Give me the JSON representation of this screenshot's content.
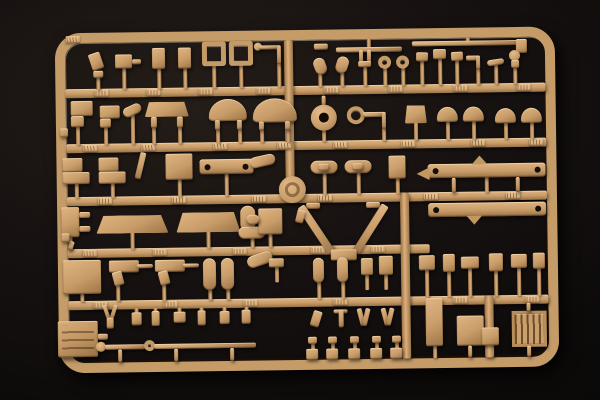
{
  "scene": {
    "description": "Photograph of a tan sand-colored injection-molded plastic model kit sprue (parts tree) holding dozens of small vehicle parts, lit from the upper left against a black studio background",
    "subject": "model-kit-sprue",
    "background": "black studio backdrop",
    "legible_text": "none (embossed part-number tabs are illegible at this resolution)"
  },
  "palette": {
    "plastic_light": "#e0b583",
    "plastic_mid": "#c89c68",
    "plastic_dark": "#9a7246",
    "plastic_shadow": "#5f422a",
    "hole_dark": "#140d07",
    "background_center": "#241d18",
    "background_edge": "#080706"
  },
  "frame": {
    "x": 57,
    "y": 30,
    "w": 500,
    "h": 340,
    "border": 10,
    "radius": 26
  },
  "runners": [
    [
      "main-runner-h1",
      67,
      86,
      480,
      9
    ],
    [
      "main-runner-h2",
      67,
      141,
      480,
      9
    ],
    [
      "main-runner-h3",
      67,
      194,
      480,
      9
    ],
    [
      "main-runner-h4",
      67,
      246,
      362,
      9
    ],
    [
      "main-runner-h5",
      67,
      298,
      480,
      9
    ],
    [
      "main-runner-v-top",
      286,
      40,
      9,
      156
    ],
    [
      "main-runner-v-bottom",
      400,
      194,
      9,
      166
    ],
    [
      "main-runner-v-right",
      483,
      298,
      9,
      62
    ]
  ],
  "tabs": {
    "w": 14,
    "h": 7,
    "positions": [
      [
        68,
        33
      ],
      [
        96,
        87
      ],
      [
        148,
        87
      ],
      [
        200,
        87
      ],
      [
        258,
        87
      ],
      [
        326,
        87
      ],
      [
        390,
        87
      ],
      [
        455,
        87
      ],
      [
        518,
        87
      ],
      [
        84,
        142
      ],
      [
        142,
        142
      ],
      [
        214,
        142
      ],
      [
        278,
        142
      ],
      [
        334,
        142
      ],
      [
        402,
        142
      ],
      [
        472,
        142
      ],
      [
        530,
        142
      ],
      [
        98,
        195
      ],
      [
        172,
        195
      ],
      [
        252,
        195
      ],
      [
        318,
        195
      ],
      [
        424,
        195
      ],
      [
        506,
        195
      ],
      [
        82,
        247
      ],
      [
        152,
        247
      ],
      [
        232,
        247
      ],
      [
        310,
        247
      ],
      [
        370,
        247
      ],
      [
        92,
        299
      ],
      [
        162,
        299
      ],
      [
        242,
        299
      ],
      [
        332,
        299
      ],
      [
        452,
        299
      ],
      [
        524,
        299
      ]
    ]
  },
  "part_format": "[name, shape, x, y, w, h, rotation_deg, stem_px(+down/-up)]",
  "parts": [
    [
      "seat-part",
      "r",
      92,
      50,
      12,
      17,
      -18,
      0
    ],
    [
      "seat-foot",
      "r",
      95,
      68,
      10,
      7,
      0,
      12
    ],
    [
      "gearbox-part",
      "r",
      117,
      52,
      17,
      14,
      0,
      21
    ],
    [
      "gearbox-arm",
      "r",
      134,
      57,
      9,
      5,
      0,
      0
    ],
    [
      "tall-part-a",
      "r",
      154,
      46,
      13,
      21,
      0,
      20
    ],
    [
      "tall-part-b",
      "r",
      180,
      46,
      13,
      21,
      0,
      20
    ],
    [
      "seat-frame-a",
      "fr",
      204,
      40,
      24,
      25,
      0,
      22
    ],
    [
      "seat-frame-b",
      "fr",
      231,
      40,
      24,
      25,
      0,
      22
    ],
    [
      "rod-arm-tip",
      "c",
      256,
      42,
      8,
      8,
      0,
      0
    ],
    [
      "rod-arm-h",
      "r",
      261,
      45,
      20,
      4,
      0,
      0
    ],
    [
      "rod-arm-v",
      "r",
      279,
      45,
      4,
      19,
      0,
      23
    ],
    [
      "bar-small",
      "r",
      316,
      44,
      14,
      6,
      0,
      0
    ],
    [
      "spring-bar",
      "r",
      338,
      48,
      66,
      5,
      0,
      -8
    ],
    [
      "long-rod",
      "r",
      414,
      43,
      112,
      5,
      0,
      -3
    ],
    [
      "clevis-part",
      "r",
      518,
      42,
      11,
      14,
      0,
      0
    ],
    [
      "leaf-part-a",
      "cap",
      316,
      58,
      12,
      17,
      -20,
      12
    ],
    [
      "leaf-part-b",
      "cap",
      338,
      57,
      12,
      17,
      18,
      13
    ],
    [
      "u-bracket-l",
      "r",
      361,
      51,
      4,
      13,
      0,
      0
    ],
    [
      "u-bracket-r",
      "r",
      369,
      51,
      4,
      13,
      0,
      0
    ],
    [
      "u-bracket-base",
      "r",
      360,
      62,
      13,
      6,
      0,
      19
    ],
    [
      "ring-part-a",
      "ring",
      380,
      57,
      13,
      13,
      0,
      17
    ],
    [
      "ring-part-b",
      "ring",
      398,
      57,
      13,
      13,
      0,
      17
    ],
    [
      "post-head-a",
      "r",
      418,
      54,
      12,
      9,
      2,
      24
    ],
    [
      "post-head-b",
      "r",
      435,
      51,
      13,
      10,
      0,
      26
    ],
    [
      "post-head-c",
      "r",
      453,
      54,
      12,
      9,
      -2,
      24
    ],
    [
      "elbow-part-h",
      "r",
      468,
      58,
      14,
      5,
      0,
      0
    ],
    [
      "elbow-part-v",
      "r",
      478,
      58,
      4,
      14,
      0,
      15
    ],
    [
      "flat-part",
      "cap",
      489,
      62,
      17,
      6,
      -8,
      19
    ],
    [
      "knob-part",
      "c",
      511,
      53,
      11,
      11,
      0,
      0
    ],
    [
      "knob-body",
      "r",
      513,
      63,
      8,
      8,
      0,
      16
    ],
    [
      "step-bracket-a",
      "r",
      72,
      98,
      22,
      15,
      0,
      0
    ],
    [
      "step-bracket-a2",
      "r",
      72,
      113,
      13,
      11,
      0,
      18
    ],
    [
      "step-bracket-b",
      "r",
      101,
      103,
      20,
      13,
      0,
      0
    ],
    [
      "step-bracket-b2",
      "r",
      101,
      116,
      11,
      9,
      0,
      17
    ],
    [
      "wing-part-a",
      "cap",
      124,
      103,
      19,
      10,
      -24,
      29
    ],
    [
      "shelf-part",
      "tz",
      146,
      100,
      44,
      15,
      0,
      0
    ],
    [
      "shelf-foot-a",
      "r",
      152,
      115,
      6,
      11,
      0,
      16
    ],
    [
      "shelf-foot-b",
      "r",
      178,
      115,
      6,
      11,
      0,
      16
    ],
    [
      "fender-a",
      "dm",
      210,
      98,
      38,
      22,
      0,
      0
    ],
    [
      "fender-a-foot1",
      "r",
      216,
      119,
      5,
      10,
      0,
      13
    ],
    [
      "fender-a-foot2",
      "r",
      238,
      119,
      5,
      10,
      0,
      13
    ],
    [
      "fender-b",
      "dm",
      254,
      98,
      44,
      24,
      0,
      0
    ],
    [
      "fender-b-foot1",
      "r",
      260,
      121,
      5,
      9,
      0,
      12
    ],
    [
      "fender-b-foot2",
      "r",
      286,
      121,
      5,
      9,
      0,
      12
    ],
    [
      "hub-stem-up",
      "r",
      323,
      96,
      4,
      10,
      0,
      0
    ],
    [
      "hub-part",
      "ch",
      312,
      105,
      26,
      26,
      0,
      11
    ],
    [
      "ring-arm-ring",
      "ring",
      348,
      107,
      18,
      18,
      0,
      0
    ],
    [
      "ring-arm-bar",
      "r",
      364,
      113,
      22,
      5,
      0,
      0
    ],
    [
      "ring-arm-post",
      "r",
      383,
      113,
      4,
      17,
      0,
      12
    ],
    [
      "bell-part",
      "tz",
      406,
      107,
      22,
      18,
      0,
      17
    ],
    [
      "dome-part-a",
      "dm",
      438,
      109,
      21,
      15,
      0,
      18
    ],
    [
      "dome-part-b",
      "dm",
      464,
      109,
      21,
      15,
      0,
      18
    ],
    [
      "dome-part-c",
      "dm",
      496,
      111,
      21,
      15,
      0,
      16
    ],
    [
      "dome-part-d",
      "dm",
      522,
      111,
      21,
      15,
      0,
      16
    ],
    [
      "l-bracket-a1",
      "r",
      63,
      155,
      20,
      14,
      0,
      0
    ],
    [
      "l-bracket-a2",
      "r",
      63,
      169,
      27,
      12,
      0,
      14
    ],
    [
      "l-bracket-b1",
      "r",
      99,
      155,
      20,
      14,
      0,
      0
    ],
    [
      "l-bracket-b2",
      "r",
      99,
      169,
      27,
      12,
      0,
      14
    ],
    [
      "s-link",
      "r",
      138,
      150,
      6,
      27,
      14,
      0
    ],
    [
      "plate-part",
      "r",
      166,
      152,
      27,
      26,
      0,
      17
    ],
    [
      "link-beam",
      "bm",
      200,
      158,
      54,
      15,
      0,
      22
    ],
    [
      "winged-link",
      "cap",
      250,
      155,
      26,
      11,
      -12,
      0
    ],
    [
      "sprue-boss",
      "lg",
      279,
      176,
      27,
      27,
      0,
      0
    ],
    [
      "boat-part-a",
      "cap",
      311,
      161,
      27,
      13,
      0,
      21
    ],
    [
      "boat-core-a",
      "r",
      319,
      164,
      10,
      7,
      0,
      0
    ],
    [
      "boat-part-b",
      "cap",
      345,
      161,
      27,
      13,
      0,
      21
    ],
    [
      "boat-core-b",
      "r",
      353,
      164,
      10,
      7,
      0,
      0
    ],
    [
      "canister-part",
      "r",
      389,
      157,
      17,
      23,
      0,
      15
    ],
    [
      "chassis-rail-a",
      "bm",
      428,
      166,
      118,
      14,
      0,
      15
    ],
    [
      "rail-a-peak",
      "tri",
      472,
      158,
      16,
      9,
      0,
      0
    ],
    [
      "rail-a-end",
      "tri",
      417,
      169,
      13,
      13,
      -90,
      0
    ],
    [
      "chassis-rail-b",
      "bm",
      428,
      205,
      118,
      14,
      0,
      0
    ],
    [
      "rail-b-notch",
      "tri",
      466,
      218,
      16,
      9,
      180,
      0
    ],
    [
      "rail-gate-1",
      "r",
      452,
      180,
      4,
      15,
      0,
      0
    ],
    [
      "rail-gate-2",
      "r",
      516,
      180,
      4,
      15,
      0,
      0
    ],
    [
      "caliper-part",
      "r",
      61,
      204,
      18,
      30,
      0,
      13
    ],
    [
      "caliper-arm-a",
      "r",
      79,
      209,
      11,
      6,
      0,
      0
    ],
    [
      "caliper-arm-b",
      "r",
      79,
      223,
      11,
      6,
      0,
      0
    ],
    [
      "beam-a",
      "tz",
      96,
      213,
      72,
      18,
      0,
      16
    ],
    [
      "beam-b",
      "tz",
      176,
      211,
      64,
      20,
      0,
      16
    ],
    [
      "elbow-pipe",
      "cap",
      240,
      205,
      15,
      26,
      0,
      0
    ],
    [
      "elbow-pipe-2",
      "cap",
      238,
      226,
      27,
      12,
      0,
      9
    ],
    [
      "tiny-fork",
      "r",
      68,
      238,
      5,
      9,
      18,
      0
    ],
    [
      "block-pipe",
      "r",
      258,
      208,
      24,
      26,
      0,
      13
    ],
    [
      "block-pipe-arm",
      "cap",
      246,
      214,
      13,
      10,
      0,
      0
    ],
    [
      "v-mount-left",
      "r",
      306,
      203,
      14,
      6,
      0,
      0
    ],
    [
      "v-mount-right",
      "r",
      366,
      203,
      14,
      6,
      0,
      0
    ],
    [
      "v-arm-left",
      "r",
      312,
      202,
      8,
      56,
      -33,
      0
    ],
    [
      "v-arm-right",
      "r",
      366,
      202,
      8,
      56,
      33,
      0
    ],
    [
      "v-apex",
      "r",
      330,
      250,
      26,
      11,
      0,
      0
    ],
    [
      "v-spike",
      "r",
      340,
      259,
      6,
      15,
      0,
      0
    ],
    [
      "hook-left",
      "r",
      296,
      210,
      8,
      13,
      14,
      0
    ],
    [
      "big-box",
      "r",
      62,
      257,
      38,
      34,
      0,
      8
    ],
    [
      "pistol-part-a",
      "r",
      108,
      258,
      30,
      12,
      0,
      0
    ],
    [
      "pistol-grip-a",
      "r",
      112,
      269,
      10,
      14,
      -14,
      16
    ],
    [
      "pistol-bar-a",
      "r",
      136,
      262,
      16,
      4,
      0,
      0
    ],
    [
      "pistol-part-b",
      "r",
      154,
      258,
      30,
      12,
      0,
      0
    ],
    [
      "pistol-grip-b",
      "r",
      158,
      269,
      10,
      14,
      -14,
      16
    ],
    [
      "pistol-bar-b",
      "r",
      182,
      262,
      16,
      4,
      0,
      0
    ],
    [
      "bottle-part-a",
      "cap",
      202,
      257,
      13,
      32,
      0,
      10
    ],
    [
      "bottle-part-b",
      "cap",
      220,
      257,
      13,
      32,
      0,
      10
    ],
    [
      "wing-part-b",
      "cap",
      246,
      253,
      26,
      12,
      -18,
      0
    ],
    [
      "wing-part-b2",
      "r",
      268,
      258,
      15,
      9,
      0,
      15
    ],
    [
      "capsule-c1",
      "cap",
      312,
      258,
      11,
      25,
      0,
      16
    ],
    [
      "capsule-c2",
      "cap",
      336,
      258,
      11,
      25,
      0,
      16
    ],
    [
      "fitting-c1",
      "r",
      360,
      259,
      12,
      17,
      0,
      15
    ],
    [
      "fitting-c2",
      "r",
      378,
      257,
      14,
      19,
      0,
      15
    ],
    [
      "bracket-r1",
      "r",
      418,
      257,
      16,
      15,
      0,
      27
    ],
    [
      "bracket-r2",
      "r",
      442,
      256,
      12,
      18,
      0,
      25
    ],
    [
      "bracket-r3",
      "r",
      460,
      259,
      18,
      12,
      0,
      28
    ],
    [
      "bracket-r4",
      "r",
      488,
      256,
      14,
      18,
      0,
      25
    ],
    [
      "bracket-r5",
      "r",
      510,
      257,
      16,
      14,
      0,
      28
    ],
    [
      "bracket-r6",
      "r",
      532,
      256,
      12,
      16,
      0,
      27
    ],
    [
      "panel-box",
      "pb",
      56,
      318,
      40,
      36,
      0,
      0
    ],
    [
      "panel-box-arm",
      "r",
      96,
      331,
      10,
      6,
      0,
      0
    ],
    [
      "fork-y-left",
      "r",
      103,
      302,
      4,
      15,
      -18,
      0
    ],
    [
      "fork-y-right",
      "r",
      110,
      302,
      4,
      15,
      18,
      0
    ],
    [
      "fork-y-base",
      "r",
      105,
      315,
      7,
      11,
      0,
      0
    ],
    [
      "tiny-part-1",
      "r",
      130,
      310,
      10,
      13,
      0,
      -4
    ],
    [
      "tiny-part-2",
      "r",
      150,
      309,
      8,
      15,
      0,
      -3
    ],
    [
      "tiny-part-3",
      "r",
      172,
      310,
      12,
      11,
      0,
      -4
    ],
    [
      "tiny-part-4",
      "r",
      196,
      309,
      8,
      15,
      0,
      -3
    ],
    [
      "tiny-part-5",
      "r",
      218,
      310,
      10,
      13,
      0,
      -4
    ],
    [
      "tiny-part-6",
      "r",
      240,
      309,
      9,
      14,
      0,
      -3
    ],
    [
      "axle-rod-a-head",
      "c",
      94,
      339,
      10,
      10,
      0,
      0
    ],
    [
      "axle-rod-a",
      "r",
      103,
      342,
      40,
      5,
      0,
      0
    ],
    [
      "axle-rod-b-head",
      "ring",
      142,
      338,
      11,
      11,
      0,
      0
    ],
    [
      "axle-rod-b",
      "r",
      152,
      342,
      102,
      5,
      0,
      0
    ],
    [
      "rod-gate-1",
      "r",
      116,
      347,
      4,
      13,
      0,
      0
    ],
    [
      "rod-gate-2",
      "r",
      172,
      347,
      4,
      13,
      0,
      0
    ],
    [
      "rod-gate-3",
      "r",
      228,
      347,
      4,
      13,
      0,
      0
    ],
    [
      "hook-c",
      "r",
      310,
      311,
      9,
      16,
      18,
      0
    ],
    [
      "faucet-h",
      "r",
      332,
      310,
      14,
      4,
      0,
      0
    ],
    [
      "faucet-v",
      "r",
      337,
      310,
      5,
      18,
      0,
      0
    ],
    [
      "scissor-a1",
      "r",
      357,
      309,
      5,
      18,
      -14,
      0
    ],
    [
      "scissor-a2",
      "r",
      362,
      309,
      5,
      18,
      14,
      0
    ],
    [
      "scissor-b1",
      "r",
      381,
      309,
      5,
      18,
      -14,
      0
    ],
    [
      "scissor-b2",
      "r",
      386,
      309,
      5,
      18,
      14,
      0
    ],
    [
      "t-post-1-head",
      "r",
      306,
      337,
      9,
      7,
      0,
      6
    ],
    [
      "t-post-1-foot",
      "r",
      304,
      349,
      12,
      11,
      0,
      0
    ],
    [
      "t-post-2-head",
      "r",
      326,
      337,
      9,
      7,
      0,
      6
    ],
    [
      "t-post-2-foot",
      "r",
      324,
      349,
      12,
      11,
      0,
      0
    ],
    [
      "t-post-3-head",
      "r",
      348,
      337,
      9,
      7,
      0,
      6
    ],
    [
      "t-post-3-foot",
      "r",
      346,
      349,
      12,
      11,
      0,
      0
    ],
    [
      "t-post-4-head",
      "r",
      370,
      337,
      9,
      7,
      0,
      6
    ],
    [
      "t-post-4-foot",
      "r",
      368,
      349,
      12,
      11,
      0,
      0
    ],
    [
      "t-post-5-head",
      "r",
      390,
      337,
      9,
      7,
      0,
      6
    ],
    [
      "t-post-5-foot",
      "r",
      388,
      349,
      12,
      11,
      0,
      0
    ],
    [
      "tall-box",
      "r",
      424,
      300,
      17,
      48,
      0,
      12
    ],
    [
      "step-box",
      "r",
      455,
      318,
      27,
      30,
      0,
      0
    ],
    [
      "step-box-2",
      "r",
      480,
      330,
      17,
      18,
      0,
      0
    ],
    [
      "step-box-gate",
      "r",
      466,
      348,
      4,
      12,
      0,
      0
    ],
    [
      "grille-part",
      "gr",
      510,
      314,
      35,
      36,
      0,
      0
    ],
    [
      "grille-gate-up",
      "r",
      525,
      306,
      4,
      9,
      0,
      0
    ],
    [
      "grille-gate-dn",
      "r",
      525,
      349,
      4,
      11,
      0,
      0
    ],
    [
      "left-nub-a",
      "r",
      61,
      125,
      8,
      9,
      0,
      0
    ],
    [
      "left-nub-b",
      "r",
      61,
      230,
      8,
      9,
      0,
      0
    ]
  ]
}
